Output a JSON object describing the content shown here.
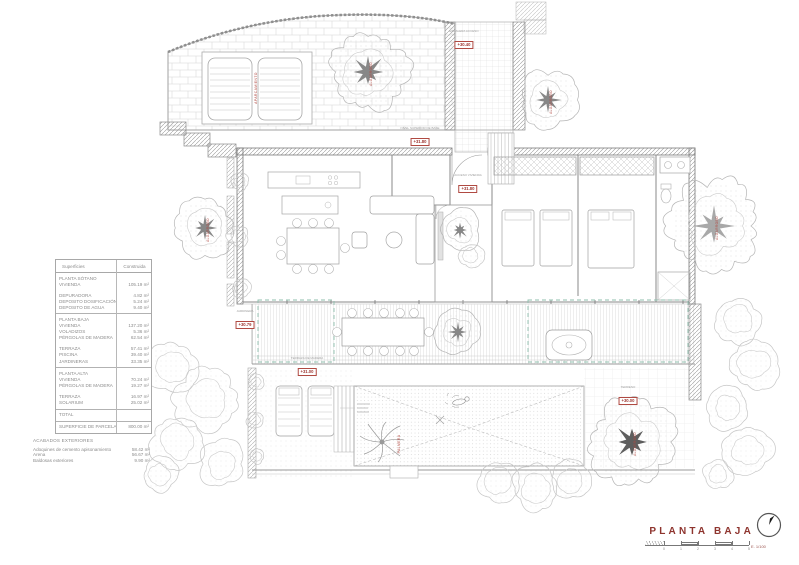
{
  "title_block": {
    "title": "PLANTA BAJA",
    "scale_label": "E. 1/100",
    "scale_ticks": [
      "0",
      "1",
      "2",
      "3",
      "4",
      "5"
    ],
    "north_icon": "north-arrow"
  },
  "accent_colors": {
    "red": "#a03a34",
    "line_gray": "#9a9a9a",
    "pergola_teal": "#8fbfae"
  },
  "area_table": {
    "col_headers": [
      "Superficies",
      "Construida"
    ],
    "groups": [
      {
        "rows": [
          [
            "PLANTA SÓTANO",
            ""
          ],
          [
            "VIVIENDA",
            "105.19 m²"
          ],
          [
            "",
            ""
          ],
          [
            "DEPURADORA",
            "4.82 m²"
          ],
          [
            "DEPOSITO DOSIFICACIÓN",
            "5.24 m²"
          ],
          [
            "DEPOSITO DE AGUA",
            "9.40 m²"
          ]
        ]
      },
      {
        "rows": [
          [
            "PLANTA BAJA",
            ""
          ],
          [
            "VIVIENDA",
            "137.20 m²"
          ],
          [
            "VOLADIZOS",
            "5.36 m²"
          ],
          [
            "PÉRGOLAS DE MADERA",
            "62.54 m²"
          ],
          [
            "",
            ""
          ],
          [
            "TERRAZA",
            "57.41 m²"
          ],
          [
            "PISCINA",
            "39.40 m²"
          ],
          [
            "JARDINERAS",
            "33.35 m²"
          ]
        ]
      },
      {
        "rows": [
          [
            "PLANTA ALTA",
            ""
          ],
          [
            "VIVIENDA",
            "70.24 m²"
          ],
          [
            "PÉRGOLAS DE MADERA",
            "19.27 m²"
          ],
          [
            "",
            ""
          ],
          [
            "TERRAZA",
            "16.97 m²"
          ],
          [
            "SOLARIUM",
            "25.02 m²"
          ]
        ]
      },
      {
        "rows": [
          [
            "TOTAL",
            ""
          ]
        ]
      },
      {
        "rows": [
          [
            "SUPERFICIE DE PARCELA",
            "800.00 m²"
          ]
        ]
      }
    ]
  },
  "finishes": {
    "heading": "ACABADOS EXTERIORES",
    "rows": [
      [
        "Adoquines de cemento apisonamiento",
        "58.42 m²"
      ],
      [
        "Arena",
        "56.67 m²"
      ],
      [
        "Baldosas exteriores",
        "9.90 m²"
      ]
    ]
  },
  "elevation_labels": [
    {
      "text": "+30.40",
      "caption": "ESCALERA ACCESO",
      "x": 464,
      "y": 30
    },
    {
      "text": "+31.80",
      "caption": "NIVEL SUPERIOR DE BASE",
      "x": 420,
      "y": 127
    },
    {
      "text": "+31.80",
      "caption": "ACCESO VIVIENDA",
      "x": 468,
      "y": 174
    },
    {
      "text": "+30.79",
      "caption": "JARDINERA",
      "x": 245,
      "y": 310
    },
    {
      "text": "+31.00",
      "caption": "TERRAZA DE MADERA",
      "x": 307,
      "y": 357
    },
    {
      "text": "+30.00",
      "caption": "TERRENO",
      "x": 628,
      "y": 386
    }
  ],
  "plan_labels": [
    {
      "text": "APARCAMIENTO",
      "x": 257,
      "y": 88
    },
    {
      "text": "PALMERA",
      "x": 400,
      "y": 444
    }
  ],
  "trees": [
    {
      "x": 368,
      "y": 72,
      "r": 40,
      "trunk": "med",
      "label": "ALGARROBO"
    },
    {
      "x": 548,
      "y": 100,
      "r": 30,
      "trunk": "med",
      "label": "ALGARROBO"
    },
    {
      "x": 205,
      "y": 228,
      "r": 30,
      "trunk": "med",
      "label": "ALGARROBO"
    },
    {
      "x": 460,
      "y": 230,
      "r": 21,
      "trunk": "med",
      "label": null
    },
    {
      "x": 471,
      "y": 256,
      "r": 13,
      "trunk": "none",
      "label": null
    },
    {
      "x": 458,
      "y": 332,
      "r": 23,
      "trunk": "med",
      "label": null
    },
    {
      "x": 632,
      "y": 442,
      "r": 44,
      "trunk": "dark",
      "label": "ALGARROBO"
    },
    {
      "x": 714,
      "y": 226,
      "r": 46,
      "trunk": "light",
      "label": "ALGARROBO"
    },
    {
      "x": 172,
      "y": 368,
      "r": 26,
      "trunk": "none",
      "label": null
    },
    {
      "x": 206,
      "y": 400,
      "r": 32,
      "trunk": "none",
      "label": null
    },
    {
      "x": 178,
      "y": 442,
      "r": 28,
      "trunk": "none",
      "label": null
    },
    {
      "x": 222,
      "y": 464,
      "r": 24,
      "trunk": "none",
      "label": null
    },
    {
      "x": 160,
      "y": 475,
      "r": 18,
      "trunk": "none",
      "label": null
    },
    {
      "x": 498,
      "y": 482,
      "r": 22,
      "trunk": "none",
      "label": null
    },
    {
      "x": 536,
      "y": 488,
      "r": 24,
      "trunk": "none",
      "label": null
    },
    {
      "x": 570,
      "y": 480,
      "r": 20,
      "trunk": "none",
      "label": null
    },
    {
      "x": 738,
      "y": 320,
      "r": 24,
      "trunk": "none",
      "label": null
    },
    {
      "x": 754,
      "y": 364,
      "r": 26,
      "trunk": "none",
      "label": null
    },
    {
      "x": 728,
      "y": 408,
      "r": 22,
      "trunk": "none",
      "label": null
    },
    {
      "x": 748,
      "y": 450,
      "r": 26,
      "trunk": "none",
      "label": null
    },
    {
      "x": 718,
      "y": 474,
      "r": 16,
      "trunk": "none",
      "label": null
    },
    {
      "x": 240,
      "y": 182,
      "r": 9,
      "trunk": "none",
      "label": null
    },
    {
      "x": 238,
      "y": 236,
      "r": 11,
      "trunk": "none",
      "label": null
    },
    {
      "x": 241,
      "y": 288,
      "r": 10,
      "trunk": "none",
      "label": null
    },
    {
      "x": 256,
      "y": 382,
      "r": 8,
      "trunk": "none",
      "label": null
    },
    {
      "x": 255,
      "y": 420,
      "r": 9,
      "trunk": "none",
      "label": null
    },
    {
      "x": 257,
      "y": 456,
      "r": 8,
      "trunk": "none",
      "label": null
    }
  ]
}
